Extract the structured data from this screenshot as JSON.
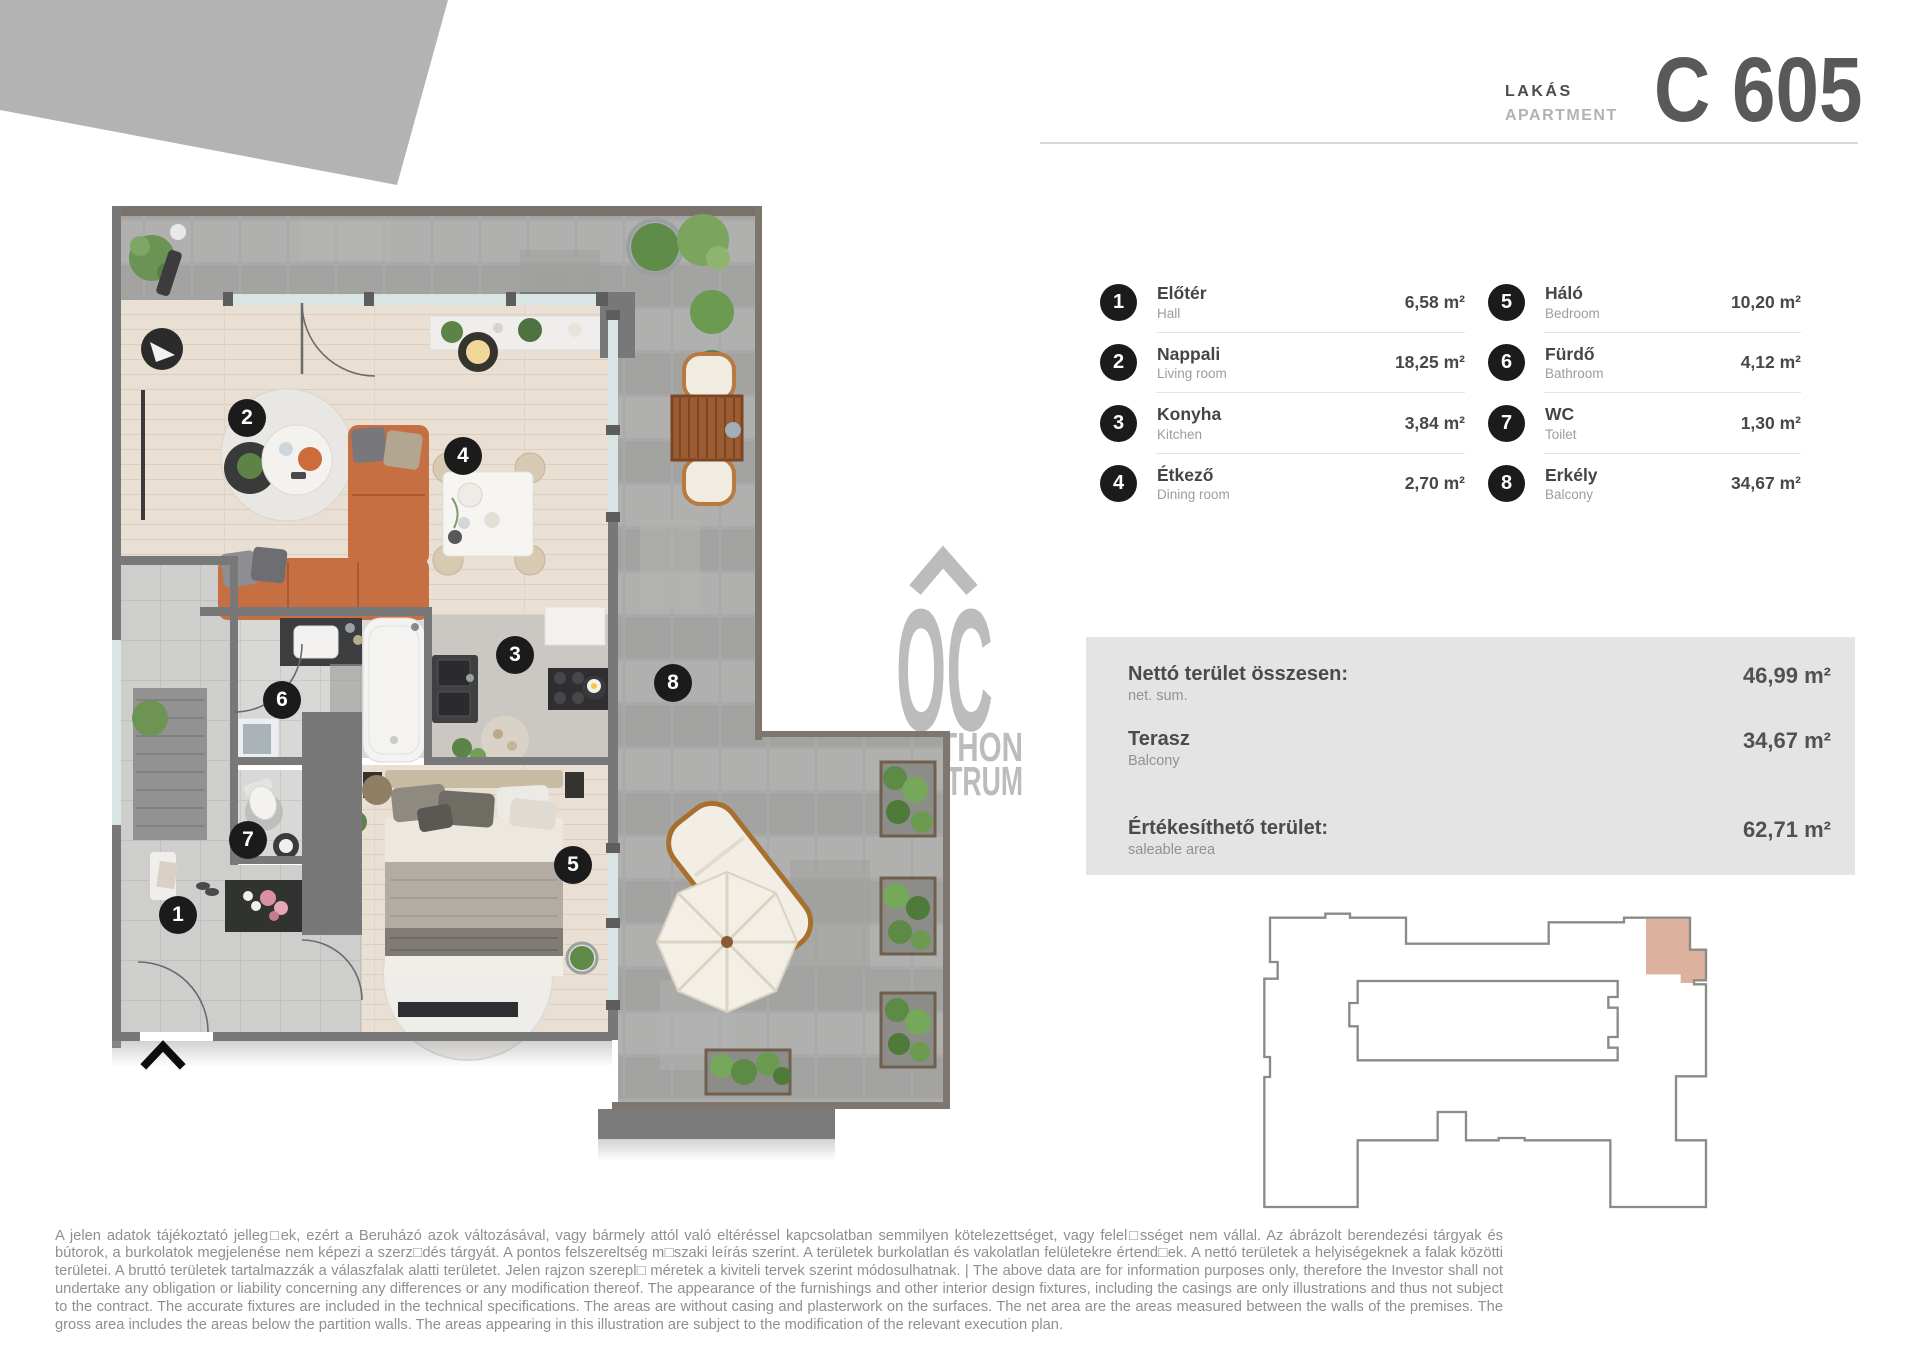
{
  "header": {
    "label_hu": "LAKÁS",
    "label_en": "APARTMENT",
    "unit": "C 605"
  },
  "rooms": [
    {
      "num": "1",
      "name_hu": "Előtér",
      "name_en": "Hall",
      "area": "6,58 m²"
    },
    {
      "num": "2",
      "name_hu": "Nappali",
      "name_en": "Living room",
      "area": "18,25 m²"
    },
    {
      "num": "3",
      "name_hu": "Konyha",
      "name_en": "Kitchen",
      "area": "3,84 m²"
    },
    {
      "num": "4",
      "name_hu": "Étkező",
      "name_en": "Dining room",
      "area": "2,70 m²"
    },
    {
      "num": "5",
      "name_hu": "Háló",
      "name_en": "Bedroom",
      "area": "10,20 m²"
    },
    {
      "num": "6",
      "name_hu": "Fürdő",
      "name_en": "Bathroom",
      "area": "4,12 m²"
    },
    {
      "num": "7",
      "name_hu": "WC",
      "name_en": "Toilet",
      "area": "1,30 m²"
    },
    {
      "num": "8",
      "name_hu": "Erkély",
      "name_en": "Balcony",
      "area": "34,67 m²"
    }
  ],
  "summary": {
    "rows": [
      {
        "label_hu": "Nettó terület összesen:",
        "label_en": "net. sum.",
        "value": "46,99 m²"
      },
      {
        "label_hu": "Terasz",
        "label_en": "Balcony",
        "value": "34,67 m²"
      },
      {
        "label_hu": "Értékesíthető terület:",
        "label_en": "saleable area",
        "value": "62,71 m²"
      }
    ]
  },
  "watermark": {
    "initials": "OC",
    "line1": "OTTHON",
    "line2": "CENTRUM"
  },
  "disclaimer": "A jelen adatok tájékoztató jelleg□ek, ezért a Beruházó azok változásával, vagy bármely attól való eltéréssel kapcsolatban semmilyen kötelezettséget, vagy felel□sséget nem vállal. Az ábrázolt berendezési tárgyak és bútorok, a burkolatok megjelenése nem képezi a szerz□dés tárgyát. A pontos felszereltség m□szaki leírás szerint. A területek burkolatlan és vakolatlan felületekre értend□ek. A nettó területek a helyiségeknek a falak közötti területei. A bruttó területek tartalmazzák a válaszfalak alatti területet. Jelen rajzon szerepl□ méretek a kiviteli tervek szerint módosulhatnak. | The above data are for information purposes only, therefore the Investor shall not undertake any obligation or liability concerning any differences or any modification thereof. The appearance of the furnishings and other interior design fixtures, including the casings are only illustrations and thus not subject to the contract. The accurate fixtures are included in the technical specifications. The areas are without casing and plasterwork on the surfaces. The net area are the areas measured between the walls of the premises. The gross area includes the areas below the partition walls. The areas appearing in this illustration are subject to the modification of the relevant execution plan.",
  "colors": {
    "highlight_unit": "#dcb19e",
    "wall": "#787878",
    "paver": "#a9a9a9",
    "wood_floor": "#e9dfd3",
    "sofa": "#c56f42",
    "logo_gray": "#bcbcbc",
    "title_gray": "#59595b",
    "badge_black": "#1b1b1b"
  }
}
